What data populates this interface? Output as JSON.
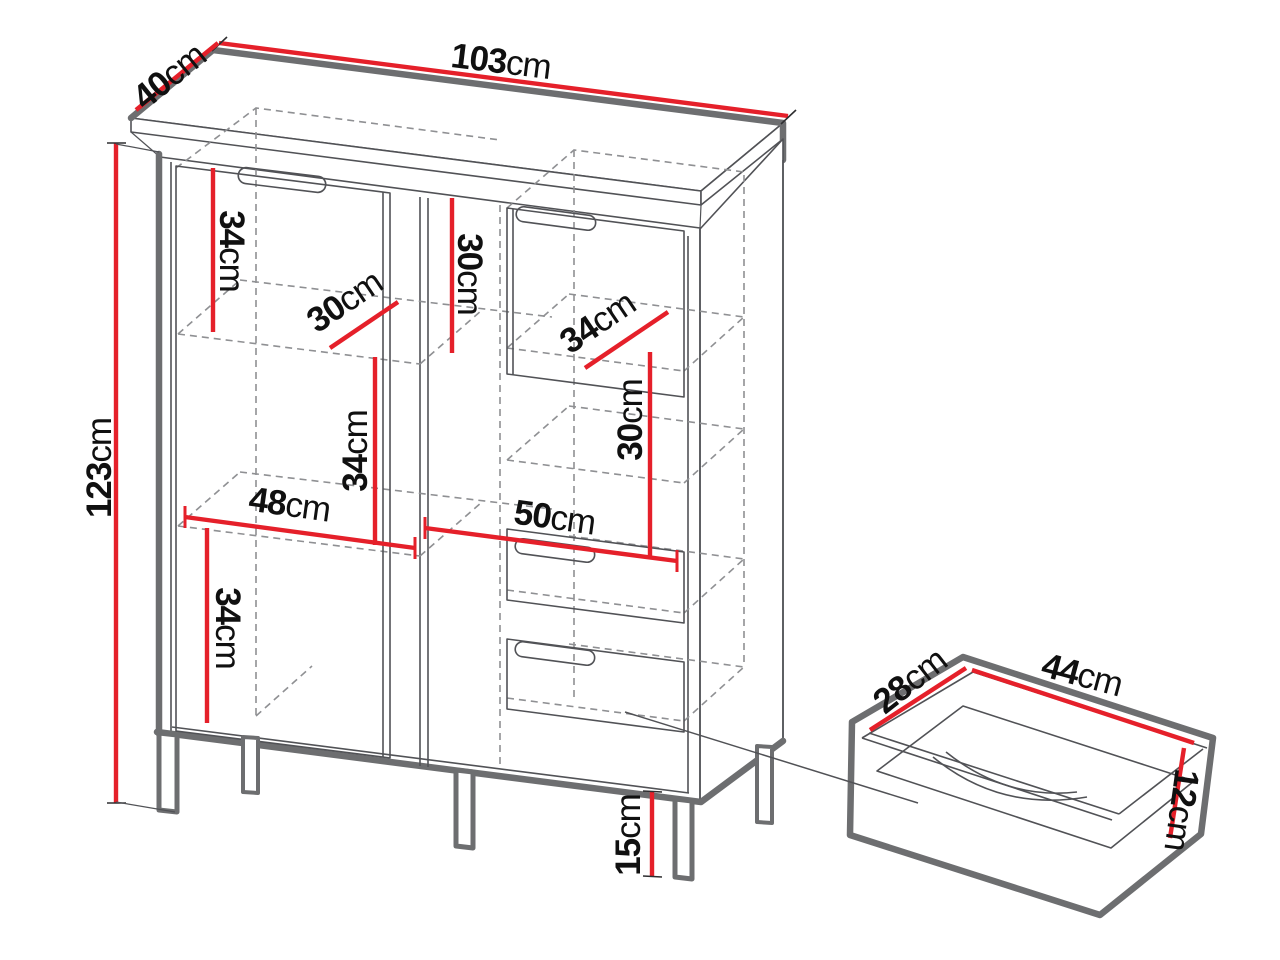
{
  "diagram": {
    "kind": "furniture-dimension-diagram",
    "unit": "cm",
    "colors": {
      "dimension_red": "#e5202a",
      "outline_thick_gray": "#6d6e70",
      "outline_thin_gray": "#515256",
      "hidden_dashed_gray": "#8f9093",
      "label_black": "#101010",
      "background": "#ffffff"
    }
  },
  "dims": {
    "width": {
      "num": "103",
      "unit": "cm"
    },
    "depth": {
      "num": "40",
      "unit": "cm"
    },
    "height": {
      "num": "123",
      "unit": "cm"
    },
    "left_top_section": {
      "num": "34",
      "unit": "cm"
    },
    "right_top_section": {
      "num": "30",
      "unit": "cm"
    },
    "left_shelf_depth": {
      "num": "30",
      "unit": "cm"
    },
    "right_shelf_depth": {
      "num": "34",
      "unit": "cm"
    },
    "left_middle_section": {
      "num": "34",
      "unit": "cm"
    },
    "right_middle_section": {
      "num": "30",
      "unit": "cm"
    },
    "left_inner_width": {
      "num": "48",
      "unit": "cm"
    },
    "right_inner_width": {
      "num": "50",
      "unit": "cm"
    },
    "left_bottom_section": {
      "num": "34",
      "unit": "cm"
    },
    "leg_height": {
      "num": "15",
      "unit": "cm"
    },
    "drawer_depth": {
      "num": "28",
      "unit": "cm"
    },
    "drawer_width": {
      "num": "44",
      "unit": "cm"
    },
    "drawer_height": {
      "num": "12",
      "unit": "cm"
    }
  }
}
